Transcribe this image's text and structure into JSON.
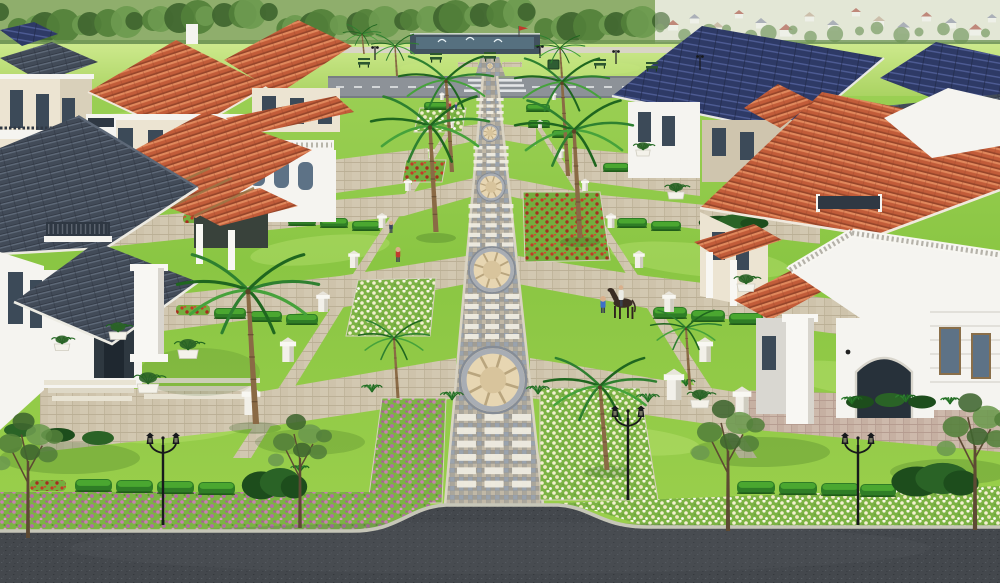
{
  "meta": {
    "description": "Aerial 3D render of a gated villa community: central paved promenade with circular medallions, symmetric lawns, flower beds, palms, street lamps, villas with terracotta, slate and navy roofs, perimeter roads, tree-lined horizon with distant town."
  },
  "palette": {
    "field-light": "#cde98c",
    "field-mid": "#aad362",
    "lawn-a": "#a3d45c",
    "lawn-b": "#8ac643",
    "lawn-c": "#9ed14e",
    "lawn-light": "#c8e87e",
    "lawn-dark": "#5f9e33",
    "lawn-shadow": "#2c5a1a",
    "tree-dark": "#3f652f",
    "tree-mid": "#53803a",
    "tree-light": "#6c9a4f",
    "hedge": "#2f7d26",
    "hedge-light": "#4fae33",
    "hedge-dark": "#1d5416",
    "bush-dark": "#1d4d1c",
    "bush-mid": "#2a6326",
    "bed-green": "#7cb344",
    "flower-pink": "#c77fb3",
    "flower-pink2": "#b46aa6",
    "flower-white": "#f4f0d2",
    "flower-red": "#c23a27",
    "walk-a": "#aaa69b",
    "walk-b": "#9aa3ad",
    "walk-c": "#c1b8a6",
    "walk-d": "#98938a",
    "walk-line": "#858c96",
    "walk-edge": "#d9d3c3",
    "paver-light": "#d2c8b1",
    "paver-line": "#b9ae94",
    "paver-warm": "#cdb9ab",
    "paver-warm-line": "#b49a8e",
    "white-paver": "#efece0",
    "step": "#e8e3d3",
    "medal-tan": "#d8c49c",
    "medal-tan2": "#e7d6b2",
    "medal-ring": "#a8adb4",
    "medal-line": "#b9a57e",
    "curb": "#c6c6b8",
    "asphalt": "#44484d",
    "asphalt-light": "#555a60",
    "asphalt-dark": "#34383d",
    "road-top": "#8d9298",
    "road-edge": "#70767c",
    "road-mark": "#eceef0",
    "terracotta": "#c25c39",
    "terracotta-light": "#e0885c",
    "terracotta-dark": "#96452a",
    "slate": "#424b58",
    "slate-light": "#5d6877",
    "slate-dark": "#2e3540",
    "navy": "#2e3a66",
    "navy-light": "#53629c",
    "navy-dark": "#1f2847",
    "wall-white": "#f5f4f0",
    "wall-shade": "#d9d7d1",
    "wall-cream": "#ece4d2",
    "wall-cream-shade": "#cfc5ae",
    "column": "#f8f7f3",
    "window": "#3c4a58",
    "window-light": "#5d7286",
    "frame": "#8a6f4a",
    "rail-dark": "#2f3843",
    "trunk": "#8a6a45",
    "trunk-dark": "#6b5134",
    "frond": "#2e8030",
    "frond-dark": "#1f661f",
    "frond-light": "#46a23b",
    "lamp": "#17191c",
    "bench": "#2c5630",
    "wood": "#9a7646",
    "pond": "#42525f",
    "pond-water": "#56707f",
    "fountain": "#e8f2f6",
    "fence": "#d9d5c6",
    "haze": "#eef1e6",
    "town-base": "#dde3cf",
    "town-wall": "#eef0ea",
    "roof-red": "#a85848",
    "roof-gray": "#8b93a2",
    "roof-tan": "#bba98f",
    "skin": "#d9b08c",
    "pants": "#39414f",
    "horse": "#3a2d24",
    "flag": "#c03a2c"
  },
  "scene": {
    "town_houses": [
      {
        "x": 668,
        "y": 20,
        "s": 10,
        "c": "roof-red"
      },
      {
        "x": 690,
        "y": 14,
        "s": 9,
        "c": "roof-gray"
      },
      {
        "x": 712,
        "y": 22,
        "s": 11,
        "c": "roof-tan"
      },
      {
        "x": 735,
        "y": 10,
        "s": 8,
        "c": "roof-red"
      },
      {
        "x": 756,
        "y": 18,
        "s": 10,
        "c": "roof-gray"
      },
      {
        "x": 780,
        "y": 24,
        "s": 12,
        "c": "roof-red"
      },
      {
        "x": 805,
        "y": 12,
        "s": 9,
        "c": "roof-tan"
      },
      {
        "x": 828,
        "y": 20,
        "s": 10,
        "c": "roof-gray"
      },
      {
        "x": 852,
        "y": 8,
        "s": 8,
        "c": "roof-red"
      },
      {
        "x": 874,
        "y": 16,
        "s": 10,
        "c": "roof-tan"
      },
      {
        "x": 898,
        "y": 22,
        "s": 11,
        "c": "roof-gray"
      },
      {
        "x": 922,
        "y": 12,
        "s": 9,
        "c": "roof-red"
      },
      {
        "x": 946,
        "y": 18,
        "s": 10,
        "c": "roof-gray"
      },
      {
        "x": 970,
        "y": 24,
        "s": 11,
        "c": "roof-red"
      },
      {
        "x": 988,
        "y": 14,
        "s": 8,
        "c": "roof-gray"
      }
    ],
    "streaks": [
      {
        "x": 120,
        "y": 200,
        "rx": 90,
        "ry": 18,
        "r": -8
      },
      {
        "x": 320,
        "y": 250,
        "rx": 70,
        "ry": 14,
        "r": -6
      },
      {
        "x": 700,
        "y": 260,
        "rx": 90,
        "ry": 16,
        "r": 6
      },
      {
        "x": 860,
        "y": 380,
        "rx": 80,
        "ry": 16,
        "r": 8
      },
      {
        "x": 180,
        "y": 430,
        "rx": 70,
        "ry": 12,
        "r": -5
      },
      {
        "x": 620,
        "y": 440,
        "rx": 80,
        "ry": 14,
        "r": 5
      },
      {
        "x": 520,
        "y": 68,
        "rx": 120,
        "ry": 10,
        "r": 0
      },
      {
        "x": 150,
        "y": 120,
        "rx": 80,
        "ry": 10,
        "r": -4
      }
    ],
    "shadows": [
      {
        "x": 70,
        "y": 458,
        "rx": 70,
        "ry": 16,
        "o": 0.22
      },
      {
        "x": 310,
        "y": 442,
        "rx": 55,
        "ry": 13,
        "o": 0.2
      },
      {
        "x": 760,
        "y": 452,
        "rx": 70,
        "ry": 15,
        "o": 0.22
      },
      {
        "x": 950,
        "y": 472,
        "rx": 60,
        "ry": 13,
        "o": 0.22
      },
      {
        "x": 200,
        "y": 372,
        "rx": 60,
        "ry": 24,
        "o": 0.15
      },
      {
        "x": 255,
        "y": 428,
        "rx": 26,
        "ry": 6,
        "o": 0.25
      },
      {
        "x": 436,
        "y": 238,
        "rx": 20,
        "ry": 5,
        "o": 0.25
      },
      {
        "x": 580,
        "y": 242,
        "rx": 20,
        "ry": 5,
        "o": 0.25
      },
      {
        "x": 608,
        "y": 472,
        "rx": 24,
        "ry": 6,
        "o": 0.25
      }
    ],
    "white_grid_bands": [
      {
        "y0": 98,
        "y1": 124,
        "rows": 4,
        "rw": 7,
        "rh": 3,
        "cx": 490
      },
      {
        "y0": 146,
        "y1": 174,
        "rows": 4,
        "rw": 9,
        "rh": 3.4,
        "cx": 491
      },
      {
        "y0": 204,
        "y1": 252,
        "rows": 5,
        "rw": 11.5,
        "rh": 4.2,
        "cx": 491
      },
      {
        "y0": 294,
        "y1": 344,
        "rows": 5,
        "rw": 14,
        "rh": 5,
        "cx": 492
      },
      {
        "y0": 414,
        "y1": 494,
        "rows": 6,
        "rw": 19,
        "rh": 6.8,
        "cx": 494
      }
    ],
    "medallions": [
      {
        "cx": 490,
        "cy": 66,
        "r": 3.5
      },
      {
        "cx": 490,
        "cy": 133,
        "r": 8.5
      },
      {
        "cx": 491,
        "cy": 187,
        "r": 14
      },
      {
        "cx": 492,
        "cy": 270,
        "r": 23
      },
      {
        "cx": 493,
        "cy": 380,
        "r": 33
      }
    ],
    "flower_beds": [
      {
        "pts": "420,108 466,108 462,132 414,132",
        "f": "white"
      },
      {
        "pts": "406,160 446,160 442,182 402,182",
        "f": "red"
      },
      {
        "pts": "358,280 436,278 430,336 346,336",
        "f": "white"
      },
      {
        "pts": "523,192 600,192 610,260 525,262",
        "f": "red"
      },
      {
        "pts": "382,398 446,398 442,503 368,503",
        "f": "pink"
      },
      {
        "pts": "540,388 640,388 658,500 540,500",
        "f": "white"
      }
    ],
    "road_strips": [
      {
        "pts": "0,492 368,492 430,503 436,531 0,531",
        "f": "pink"
      },
      {
        "pts": "560,503 1000,486 1000,527 648,527 600,512",
        "f": "white"
      }
    ],
    "hedges": [
      {
        "x": 424,
        "y": 102,
        "w": 24,
        "h": 8
      },
      {
        "x": 526,
        "y": 104,
        "w": 24,
        "h": 8
      },
      {
        "x": 528,
        "y": 120,
        "w": 22,
        "h": 8
      },
      {
        "x": 552,
        "y": 130,
        "w": 24,
        "h": 8
      },
      {
        "x": 288,
        "y": 216,
        "w": 28,
        "h": 10
      },
      {
        "x": 320,
        "y": 218,
        "w": 28,
        "h": 10
      },
      {
        "x": 352,
        "y": 221,
        "w": 28,
        "h": 10
      },
      {
        "x": 214,
        "y": 308,
        "w": 32,
        "h": 11
      },
      {
        "x": 250,
        "y": 311,
        "w": 32,
        "h": 11
      },
      {
        "x": 286,
        "y": 314,
        "w": 32,
        "h": 11
      },
      {
        "x": 75,
        "y": 479,
        "w": 37,
        "h": 13
      },
      {
        "x": 116,
        "y": 480,
        "w": 37,
        "h": 13
      },
      {
        "x": 157,
        "y": 481,
        "w": 37,
        "h": 13
      },
      {
        "x": 198,
        "y": 482,
        "w": 37,
        "h": 13
      },
      {
        "x": 603,
        "y": 163,
        "w": 26,
        "h": 9
      },
      {
        "x": 633,
        "y": 166,
        "w": 26,
        "h": 9
      },
      {
        "x": 617,
        "y": 218,
        "w": 30,
        "h": 10
      },
      {
        "x": 651,
        "y": 221,
        "w": 30,
        "h": 10
      },
      {
        "x": 653,
        "y": 307,
        "w": 34,
        "h": 12
      },
      {
        "x": 691,
        "y": 310,
        "w": 34,
        "h": 12
      },
      {
        "x": 729,
        "y": 313,
        "w": 34,
        "h": 12
      },
      {
        "x": 737,
        "y": 481,
        "w": 38,
        "h": 13
      },
      {
        "x": 779,
        "y": 482,
        "w": 38,
        "h": 13
      },
      {
        "x": 821,
        "y": 483,
        "w": 38,
        "h": 13
      },
      {
        "x": 860,
        "y": 484,
        "w": 36,
        "h": 13
      },
      {
        "x": 298,
        "y": 100,
        "w": 22,
        "h": 8
      }
    ],
    "red_strips": [
      {
        "x": 183,
        "y": 214,
        "w": 30,
        "h": 9
      },
      {
        "x": 176,
        "y": 305,
        "w": 34,
        "h": 10
      },
      {
        "x": 30,
        "y": 480,
        "w": 36,
        "h": 11
      },
      {
        "x": 905,
        "y": 476,
        "w": 50,
        "h": 12
      }
    ],
    "dark_bushes": [
      {
        "x": 243,
        "y": 470,
        "w": 60,
        "h": 28
      },
      {
        "x": 893,
        "y": 465,
        "w": 80,
        "h": 30
      },
      {
        "x": 700,
        "y": 215,
        "w": 64,
        "h": 14
      }
    ],
    "pillars": [
      {
        "x": 442,
        "y": 100,
        "s": 3
      },
      {
        "x": 554,
        "y": 100,
        "s": 3
      },
      {
        "x": 452,
        "y": 128,
        "s": 3.2
      },
      {
        "x": 431,
        "y": 158,
        "s": 4
      },
      {
        "x": 408,
        "y": 191,
        "s": 4.8
      },
      {
        "x": 382,
        "y": 228,
        "s": 5.8
      },
      {
        "x": 354,
        "y": 268,
        "s": 6.8
      },
      {
        "x": 323,
        "y": 312,
        "s": 8
      },
      {
        "x": 288,
        "y": 362,
        "s": 9.5
      },
      {
        "x": 251,
        "y": 415,
        "s": 11
      },
      {
        "x": 540,
        "y": 128,
        "s": 3.2
      },
      {
        "x": 561,
        "y": 158,
        "s": 4
      },
      {
        "x": 585,
        "y": 191,
        "s": 4.8
      },
      {
        "x": 611,
        "y": 228,
        "s": 5.8
      },
      {
        "x": 639,
        "y": 268,
        "s": 6.8
      },
      {
        "x": 669,
        "y": 312,
        "s": 8
      },
      {
        "x": 705,
        "y": 362,
        "s": 9.5
      },
      {
        "x": 742,
        "y": 415,
        "s": 11
      },
      {
        "x": 674,
        "y": 400,
        "s": 12
      }
    ],
    "palms": [
      {
        "cx": 362,
        "cy": 34,
        "bx": 364,
        "by": 54,
        "s": 0.32
      },
      {
        "cx": 395,
        "cy": 46,
        "bx": 397,
        "by": 76,
        "s": 0.4
      },
      {
        "cx": 560,
        "cy": 48,
        "bx": 562,
        "by": 78,
        "s": 0.42
      },
      {
        "cx": 446,
        "cy": 80,
        "bx": 452,
        "by": 172,
        "s": 0.8
      },
      {
        "cx": 562,
        "cy": 82,
        "bx": 568,
        "by": 176,
        "s": 0.8
      },
      {
        "cx": 430,
        "cy": 126,
        "bx": 436,
        "by": 232,
        "s": 1.0
      },
      {
        "cx": 574,
        "cy": 130,
        "bx": 580,
        "by": 238,
        "s": 1.0
      },
      {
        "cx": 248,
        "cy": 290,
        "bx": 256,
        "by": 424,
        "s": 1.2
      },
      {
        "cx": 600,
        "cy": 386,
        "bx": 607,
        "by": 470,
        "s": 0.95
      },
      {
        "cx": 394,
        "cy": 338,
        "bx": 398,
        "by": 398,
        "s": 0.6
      },
      {
        "cx": 686,
        "cy": 328,
        "bx": 690,
        "by": 390,
        "s": 0.6
      }
    ],
    "lamps": [
      {
        "x": 163,
        "y": 437,
        "h": 88
      },
      {
        "x": 858,
        "y": 437,
        "h": 88
      },
      {
        "x": 628,
        "y": 410,
        "h": 90
      }
    ],
    "mini_lamps": [
      {
        "x": 375,
        "y": 46,
        "h": 14
      },
      {
        "x": 540,
        "y": 45,
        "h": 13
      },
      {
        "x": 616,
        "y": 50,
        "h": 14
      },
      {
        "x": 700,
        "y": 55,
        "h": 15
      }
    ],
    "benches": [
      {
        "x": 358,
        "y": 62
      },
      {
        "x": 430,
        "y": 57
      },
      {
        "x": 484,
        "y": 56
      },
      {
        "x": 594,
        "y": 63
      },
      {
        "x": 646,
        "y": 66
      }
    ],
    "trees": [
      {
        "x": 28,
        "y": 472,
        "s": 1.1
      },
      {
        "x": 300,
        "y": 468,
        "s": 1.0
      },
      {
        "x": 728,
        "y": 462,
        "s": 1.15
      },
      {
        "x": 975,
        "y": 458,
        "s": 1.2
      }
    ],
    "planters": [
      {
        "x": 118,
        "y": 332,
        "s": 15
      },
      {
        "x": 188,
        "y": 350,
        "s": 17
      },
      {
        "x": 62,
        "y": 344,
        "s": 13
      },
      {
        "x": 148,
        "y": 384,
        "s": 18
      },
      {
        "x": 643,
        "y": 150,
        "s": 12
      },
      {
        "x": 676,
        "y": 192,
        "s": 14
      },
      {
        "x": 746,
        "y": 284,
        "s": 15
      },
      {
        "x": 700,
        "y": 400,
        "s": 16
      }
    ],
    "tufts": [
      {
        "x": 372,
        "y": 392,
        "s": 9
      },
      {
        "x": 452,
        "y": 400,
        "s": 10
      },
      {
        "x": 538,
        "y": 394,
        "s": 10
      },
      {
        "x": 648,
        "y": 402,
        "s": 10
      },
      {
        "x": 686,
        "y": 386,
        "s": 8
      },
      {
        "x": 300,
        "y": 472,
        "s": 8
      },
      {
        "x": 852,
        "y": 404,
        "s": 9
      },
      {
        "x": 906,
        "y": 402,
        "s": 9
      },
      {
        "x": 950,
        "y": 404,
        "s": 8
      }
    ],
    "people": [
      {
        "x": 398,
        "y": 262,
        "h": 15,
        "c": "#c23a2f"
      },
      {
        "x": 391,
        "y": 233,
        "h": 12,
        "c": "#3a4560"
      },
      {
        "x": 603,
        "y": 313,
        "h": 17,
        "c": "#3d6fc9"
      },
      {
        "x": 450,
        "y": 109,
        "h": 8,
        "c": "#b03535"
      },
      {
        "x": 456,
        "y": 110,
        "h": 8,
        "c": "#35508a"
      }
    ]
  }
}
